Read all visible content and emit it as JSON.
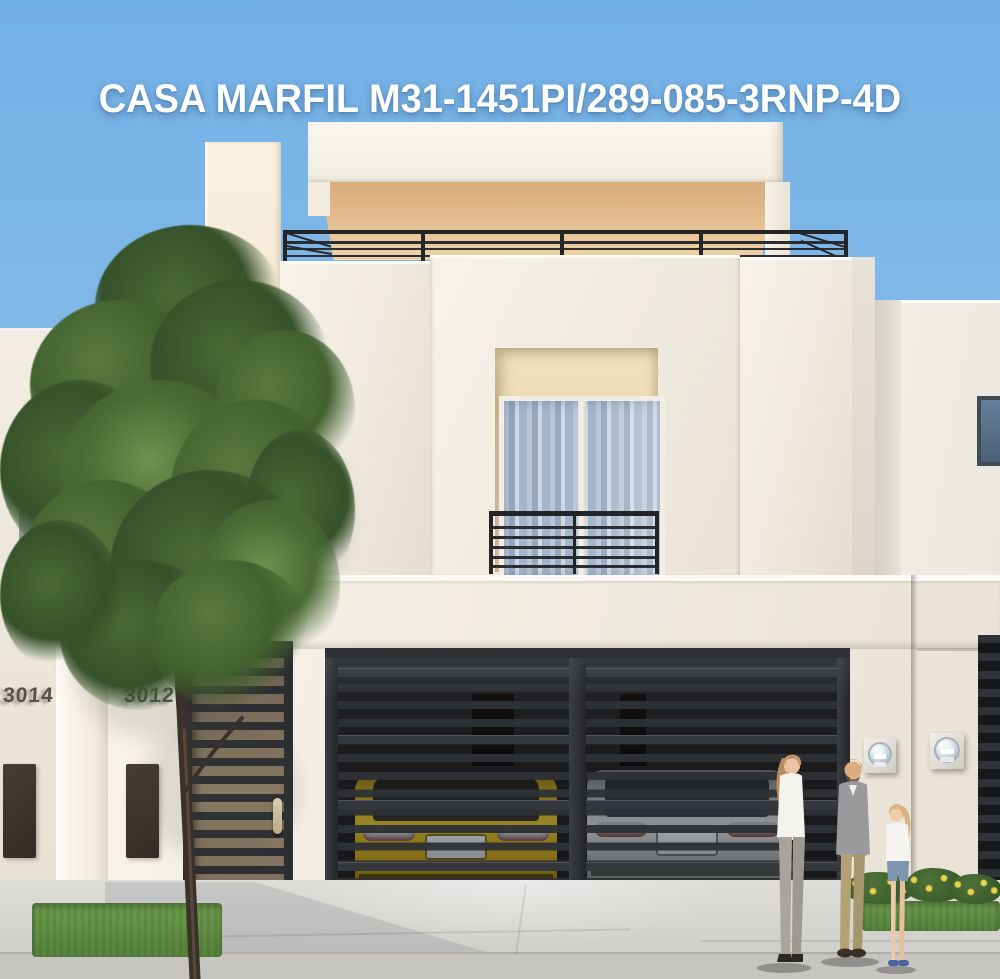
{
  "title": "CASA MARFIL M31-1451PI/289-085-3RNP-4D",
  "houses": {
    "main_number": "3012",
    "left_neighbor_number": "3014"
  },
  "scene": {
    "alt": "Street-front render of a two-story ivory house with rooftop terrace railing, recessed balcony window, dark slatted pedestrian gate and double garage gate revealing a yellow car and a silver car, a tall tree at left and a family of three standing at right"
  },
  "colors": {
    "sky_top": "#73b0e5",
    "sky_bottom": "#9cc8f0",
    "wall_light": "#f0ebe0",
    "wall_shadow": "#e4ded1",
    "cream_tower": "#efddbd",
    "canopy_underside": "#e2ba8b",
    "metal_dark": "#2b2d31",
    "glass_blue": "#a4b6cb",
    "car_yellow": "#d9bd2e",
    "car_silver": "#d4d7da",
    "foliage": "#35522a",
    "trunk_brown": "#3a322a",
    "grass": "#6d9c4d",
    "flower_yellow": "#e8d24a",
    "pavement": "#d2d1cd",
    "street": "#c6c5c1",
    "skin_tone": "#e9c2a4",
    "denim_blue": "#7e95b0",
    "sweater_gray": "#9a999b",
    "khaki": "#b4a277"
  }
}
